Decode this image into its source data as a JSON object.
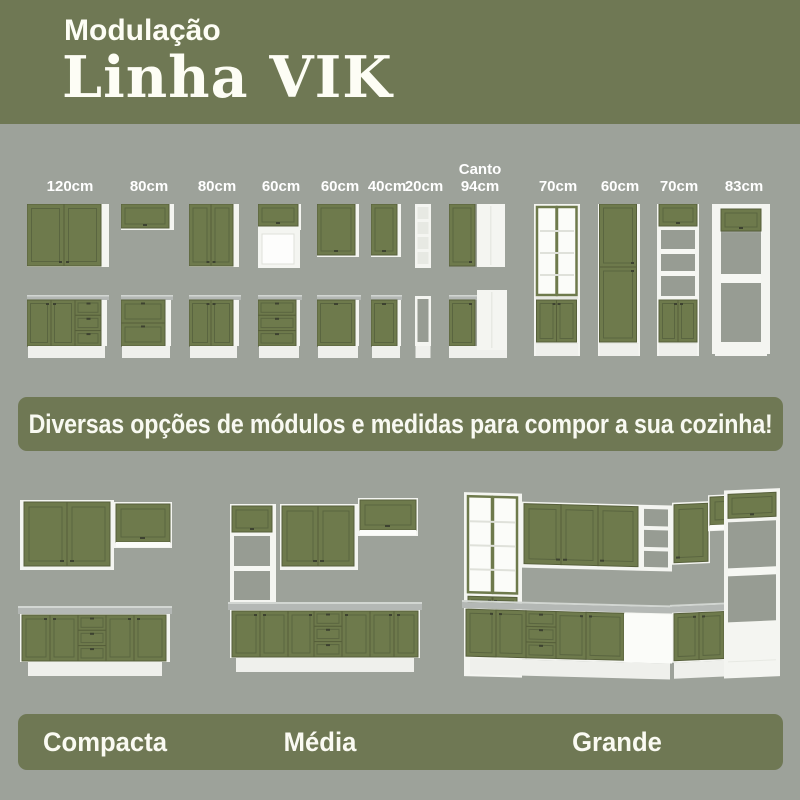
{
  "header": {
    "kicker": "Modulação",
    "title": "Linha VIK"
  },
  "modules": {
    "items": [
      {
        "label": "120cm",
        "kind": "wall-2-doors + base-2-doors-3-drawers"
      },
      {
        "label": "80cm",
        "kind": "wall-flip-door + base-2-drawers"
      },
      {
        "label": "80cm",
        "kind": "wall-2-doors + base-2-doors"
      },
      {
        "label": "60cm",
        "kind": "wall-flip-door-with-niche + base-3-drawers"
      },
      {
        "label": "60cm",
        "kind": "wall-1-door + base-1-door"
      },
      {
        "label": "40cm",
        "kind": "wall-1-door + base-1-door"
      },
      {
        "label": "20cm",
        "kind": "open-shelf-wall + open-shelf-base"
      },
      {
        "label": "Canto 94cm",
        "kind": "corner-wall + corner-base"
      },
      {
        "label": "70cm",
        "kind": "tall-glass-display-cabinet"
      },
      {
        "label": "60cm",
        "kind": "tall-pantry-2-doors"
      },
      {
        "label": "70cm",
        "kind": "tall-flip-open-shelves-2-doors"
      },
      {
        "label": "83cm",
        "kind": "tall-oven-tower-open"
      }
    ]
  },
  "banner": {
    "text": "Diversas opções de módulos e medidas para compor a sua cozinha!"
  },
  "kitchens": {
    "items": [
      {
        "label": "Compacta"
      },
      {
        "label": "Média"
      },
      {
        "label": "Grande"
      }
    ]
  },
  "colors": {
    "header_bg": "#6f7854",
    "page_bg": "#9da29a",
    "cabinet_green": "#6e7a4c",
    "cabinet_frame": "#565f3a",
    "carcass_white": "#f4f5f1",
    "countertop_gray": "#b4b8b5",
    "text_white": "#fdfdf5"
  }
}
